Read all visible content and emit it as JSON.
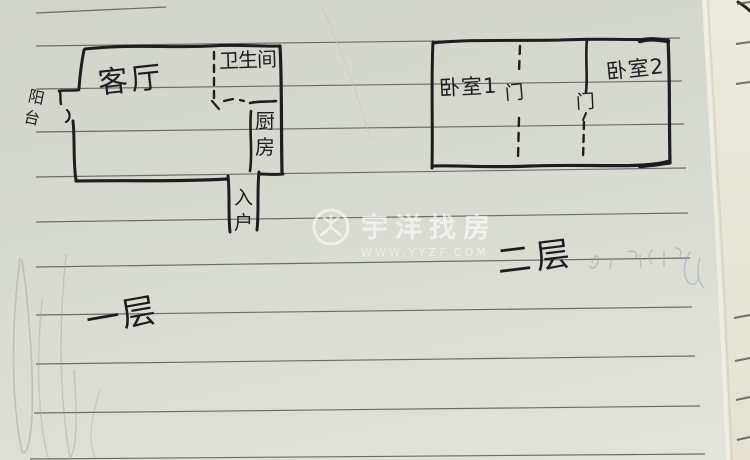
{
  "sketch": {
    "floor1": {
      "floor_label": "一层",
      "living_room": "客厅",
      "bathroom": "卫生间",
      "kitchen": "厨房",
      "entry": "入户",
      "balcony": "阳台"
    },
    "floor2": {
      "floor_label": "二层",
      "bedroom1": "卧室1",
      "door1": "门",
      "door2": "门",
      "bedroom2": "卧室2"
    }
  },
  "watermark": {
    "brand": "宇洋找房",
    "url": "WWW.YYZF.COM",
    "logo": "yyzf-circle-y-logo"
  },
  "colors": {
    "paper": "#d7dad1",
    "under_page": "#eceadb",
    "ruled_line": "#5f605b",
    "ink": "#1d1d21",
    "pencil": "#a2a39d",
    "watermark_white": "#ffffff"
  }
}
